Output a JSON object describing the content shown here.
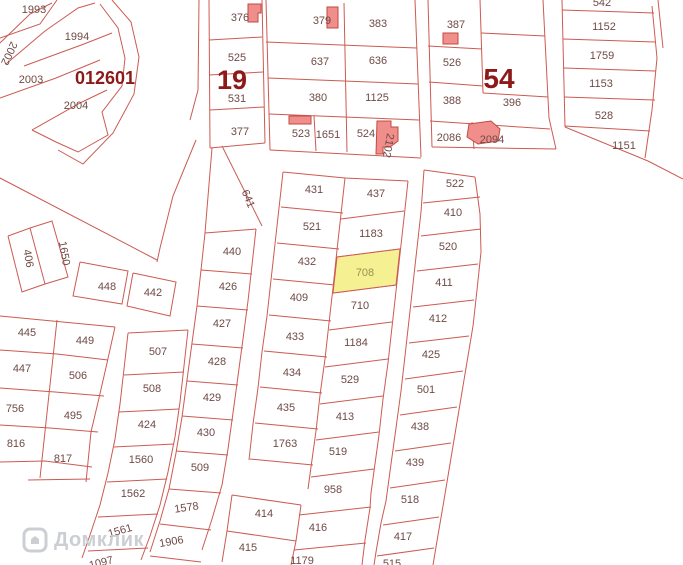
{
  "watermark": {
    "brand": "Домклик"
  },
  "colors": {
    "line": "#cc5a52",
    "label": "#6f4a46",
    "district": "#8c1a18",
    "building_fill": "#f08e8c",
    "building_stroke": "#c24a42",
    "highlight_fill": "#f5f193",
    "highlight_stroke": "#cc5a52",
    "highlight_label": "#96934f",
    "watermark": "#c7cbd1"
  },
  "district_labels": [
    {
      "text": "012601",
      "x": 105,
      "y": 84,
      "size": 18
    },
    {
      "text": "19",
      "x": 232,
      "y": 89,
      "size": 27
    },
    {
      "text": "54",
      "x": 499,
      "y": 88,
      "size": 28
    }
  ],
  "highlighted_parcel": {
    "number": "708",
    "points": "337,257 400,249 396,285 333,293",
    "label_x": 365,
    "label_y": 276
  },
  "parcel_labels": [
    {
      "t": "1993",
      "x": 34,
      "y": 13
    },
    {
      "t": "1994",
      "x": 77,
      "y": 40
    },
    {
      "t": "2002",
      "x": 6,
      "y": 52,
      "r": 115
    },
    {
      "t": "2003",
      "x": 31,
      "y": 83
    },
    {
      "t": "2004",
      "x": 76,
      "y": 109
    },
    {
      "t": "376",
      "x": 240,
      "y": 21
    },
    {
      "t": "525",
      "x": 237,
      "y": 61
    },
    {
      "t": "531",
      "x": 237,
      "y": 102
    },
    {
      "t": "377",
      "x": 240,
      "y": 135
    },
    {
      "t": "379",
      "x": 322,
      "y": 24
    },
    {
      "t": "637",
      "x": 320,
      "y": 65
    },
    {
      "t": "380",
      "x": 318,
      "y": 101
    },
    {
      "t": "523",
      "x": 301,
      "y": 137
    },
    {
      "t": "1651",
      "x": 328,
      "y": 138
    },
    {
      "t": "383",
      "x": 378,
      "y": 27
    },
    {
      "t": "636",
      "x": 378,
      "y": 64
    },
    {
      "t": "1125",
      "x": 377,
      "y": 101
    },
    {
      "t": "524",
      "x": 366,
      "y": 137
    },
    {
      "t": "2102",
      "x": 385,
      "y": 145,
      "r": 100
    },
    {
      "t": "387",
      "x": 456,
      "y": 28
    },
    {
      "t": "526",
      "x": 452,
      "y": 66
    },
    {
      "t": "388",
      "x": 452,
      "y": 104
    },
    {
      "t": "396",
      "x": 512,
      "y": 106
    },
    {
      "t": "2086",
      "x": 449,
      "y": 141
    },
    {
      "t": "2094",
      "x": 492,
      "y": 143
    },
    {
      "t": "542",
      "x": 602,
      "y": 6
    },
    {
      "t": "1152",
      "x": 604,
      "y": 30
    },
    {
      "t": "1759",
      "x": 602,
      "y": 59
    },
    {
      "t": "1153",
      "x": 601,
      "y": 87
    },
    {
      "t": "528",
      "x": 604,
      "y": 119
    },
    {
      "t": "1151",
      "x": 624,
      "y": 149
    },
    {
      "t": "522",
      "x": 455,
      "y": 187
    },
    {
      "t": "410",
      "x": 453,
      "y": 216
    },
    {
      "t": "520",
      "x": 448,
      "y": 250
    },
    {
      "t": "411",
      "x": 444,
      "y": 286
    },
    {
      "t": "412",
      "x": 438,
      "y": 322
    },
    {
      "t": "425",
      "x": 431,
      "y": 358
    },
    {
      "t": "501",
      "x": 426,
      "y": 393
    },
    {
      "t": "438",
      "x": 420,
      "y": 430
    },
    {
      "t": "439",
      "x": 415,
      "y": 466
    },
    {
      "t": "518",
      "x": 410,
      "y": 503
    },
    {
      "t": "417",
      "x": 403,
      "y": 540
    },
    {
      "t": "515",
      "x": 392,
      "y": 567
    },
    {
      "t": "431",
      "x": 314,
      "y": 193
    },
    {
      "t": "521",
      "x": 312,
      "y": 230
    },
    {
      "t": "432",
      "x": 307,
      "y": 265
    },
    {
      "t": "409",
      "x": 299,
      "y": 301
    },
    {
      "t": "433",
      "x": 295,
      "y": 340
    },
    {
      "t": "434",
      "x": 292,
      "y": 376
    },
    {
      "t": "435",
      "x": 286,
      "y": 411
    },
    {
      "t": "1763",
      "x": 285,
      "y": 447
    },
    {
      "t": "414",
      "x": 264,
      "y": 517
    },
    {
      "t": "415",
      "x": 248,
      "y": 551
    },
    {
      "t": "437",
      "x": 376,
      "y": 197
    },
    {
      "t": "1183",
      "x": 371,
      "y": 237
    },
    {
      "t": "710",
      "x": 360,
      "y": 309
    },
    {
      "t": "1184",
      "x": 356,
      "y": 346
    },
    {
      "t": "529",
      "x": 350,
      "y": 383
    },
    {
      "t": "413",
      "x": 345,
      "y": 420
    },
    {
      "t": "519",
      "x": 338,
      "y": 455
    },
    {
      "t": "958",
      "x": 333,
      "y": 493
    },
    {
      "t": "416",
      "x": 318,
      "y": 531
    },
    {
      "t": "1179",
      "x": 302,
      "y": 564
    },
    {
      "t": "641",
      "x": 245,
      "y": 200,
      "r": 68
    },
    {
      "t": "440",
      "x": 232,
      "y": 255
    },
    {
      "t": "426",
      "x": 228,
      "y": 290
    },
    {
      "t": "427",
      "x": 222,
      "y": 327
    },
    {
      "t": "428",
      "x": 217,
      "y": 365
    },
    {
      "t": "429",
      "x": 212,
      "y": 401
    },
    {
      "t": "430",
      "x": 206,
      "y": 436
    },
    {
      "t": "509",
      "x": 200,
      "y": 471
    },
    {
      "t": "1578",
      "x": 187,
      "y": 511,
      "r": -8
    },
    {
      "t": "1906",
      "x": 172,
      "y": 545,
      "r": -10
    },
    {
      "t": "507",
      "x": 158,
      "y": 355
    },
    {
      "t": "508",
      "x": 152,
      "y": 392
    },
    {
      "t": "424",
      "x": 147,
      "y": 428
    },
    {
      "t": "1560",
      "x": 141,
      "y": 463
    },
    {
      "t": "1562",
      "x": 133,
      "y": 497
    },
    {
      "t": "1561",
      "x": 121,
      "y": 534,
      "r": -16
    },
    {
      "t": "1097",
      "x": 102,
      "y": 566,
      "r": -14
    },
    {
      "t": "445",
      "x": 27,
      "y": 336
    },
    {
      "t": "449",
      "x": 85,
      "y": 344
    },
    {
      "t": "447",
      "x": 22,
      "y": 372
    },
    {
      "t": "506",
      "x": 78,
      "y": 379
    },
    {
      "t": "756",
      "x": 15,
      "y": 412
    },
    {
      "t": "495",
      "x": 73,
      "y": 419
    },
    {
      "t": "816",
      "x": 16,
      "y": 447
    },
    {
      "t": "817",
      "x": 63,
      "y": 462
    },
    {
      "t": "406",
      "x": 25,
      "y": 259,
      "r": 80
    },
    {
      "t": "1650",
      "x": 61,
      "y": 254,
      "r": 80
    },
    {
      "t": "448",
      "x": 107,
      "y": 290
    },
    {
      "t": "442",
      "x": 153,
      "y": 296
    }
  ],
  "buildings": [
    {
      "points": "248,4 261,4 261,13 258,13 258,22 248,22"
    },
    {
      "points": "327,7 338,7 338,28 327,28"
    },
    {
      "points": "289,116 311,116 311,124 289,124"
    },
    {
      "points": "377,121 391,121 391,127 398,127 398,141 390,147 383,147 383,154 376,154"
    },
    {
      "points": "443,33 458,33 458,44 443,44"
    },
    {
      "points": "469,124 491,121 500,129 498,141 478,144 467,137"
    }
  ],
  "boundary_lines": [
    "57,0 40,24 0,38",
    "0,43 30,14 52,3",
    "6,64 45,31 78,8 95,3",
    "24,66 84,44 112,33",
    "0,98 56,78 100,60",
    "32,130 80,103 107,90",
    "100,4 118,28 125,58 122,86 102,112 108,135 78,152 56,142 32,130",
    "112,0 131,22 139,57 134,94 113,133 83,164 58,150",
    "0,178 157,260",
    "196,140 173,196 160,248 157,262",
    "199,0 198,90 190,120",
    "209,0 210,148",
    "262,0 265,143",
    "209,40 262,37",
    "209,75 263,72",
    "210,110 264,107",
    "210,148 265,143",
    "266,0 270,150",
    "344,3 347,152",
    "415,0 421,157",
    "266,42 417,48",
    "268,78 418,84",
    "269,114 419,120",
    "270,150 421,158",
    "314,116 316,151",
    "428,0 432,147",
    "480,0 483,93",
    "543,0 549,118 556,149",
    "428,46 482,49",
    "429,82 483,86",
    "481,33 545,36",
    "483,93 548,97",
    "430,121 550,129",
    "472,122 474,149",
    "432,147 556,149",
    "562,0 565,127",
    "652,6 657,58 652,110 645,158",
    "562,10 654,13",
    "563,39 655,42",
    "564,68 656,71",
    "564,97 655,100",
    "565,126 650,131",
    "565,127 648,161",
    "648,161 683,179",
    "658,0 663,48",
    "424,170 475,177",
    "424,170 421,212 417,248 413,284 409,320 405,356 401,391 396,428 391,464 386,501 381,523 376,552 374,565",
    "475,177 480,214 481,252 477,290 473,326 467,362 461,398 455,434 449,470 443,506 437,541 433,565",
    "423,203 480,197",
    "421,236 481,229",
    "417,271 478,264",
    "413,307 474,300",
    "409,343 469,336",
    "405,379 463,371",
    "400,415 457,407",
    "395,451 451,443",
    "390,488 445,480",
    "383,525 439,517",
    "377,556 434,548",
    "283,172 345,178 408,181",
    "283,172 279,208 275,244 271,280 267,316 262,352 258,388 253,424 249,460",
    "345,178 341,214 337,250 333,288 329,323 325,359 320,395 316,431 311,467 308,489",
    "408,181 404,218 400,254 396,291 392,327 388,363 383,399 379,435 374,471 371,493 370,508 365,540 362,565",
    "281,207 343,213",
    "277,243 339,249",
    "273,279 335,285",
    "269,315 331,321",
    "264,351 327,357",
    "260,387 322,393",
    "255,423 318,429",
    "250,459 313,465",
    "232,495 301,505",
    "227,531 296,541",
    "232,495 227,531 222,562",
    "341,219 404,211",
    "337,257 400,249",
    "333,293 396,285",
    "329,330 392,322",
    "325,367 388,359",
    "320,404 383,396",
    "316,440 379,432",
    "311,477 374,469",
    "299,515 371,507",
    "294,550 366,543",
    "301,505 296,541 291,565",
    "205,233 201,270 197,306 192,343 187,380 182,417 176,453 169,489 160,521 150,552",
    "256,229 252,265 248,301 243,339 238,376 233,413 228,449 222,485 212,519 202,550",
    "212,148 205,233",
    "222,146 262,226",
    "205,233 256,229",
    "201,270 252,274",
    "197,306 248,310",
    "192,344 243,348",
    "187,381 238,385",
    "182,416 233,420",
    "176,451 228,455",
    "169,489 221,493",
    "160,524 211,530",
    "150,556 201,562",
    "128,333 124,369 120,404 115,439 108,473 100,505 90,535 82,558",
    "188,330 184,366 180,402 175,437 168,472 160,505 150,536 141,560",
    "128,333 188,330",
    "124,375 184,372",
    "119,412 179,409",
    "114,447 174,444",
    "107,482 167,479",
    "98,517 158,514",
    "88,551 148,548",
    "0,316 115,327",
    "57,320 40,478",
    "115,327 107,363 99,398 91,432 86,482",
    "0,350 57,354 108,360",
    "0,388 55,392 104,396",
    "0,425 50,428 98,432",
    "0,462 45,461 92,467",
    "28,480 90,479",
    "8,236 30,228 45,284 22,292 8,236",
    "30,228 52,221 68,277 45,284",
    "80,262 128,271 122,304 73,296 80,262",
    "133,273 176,282 170,316 127,306 133,273"
  ]
}
